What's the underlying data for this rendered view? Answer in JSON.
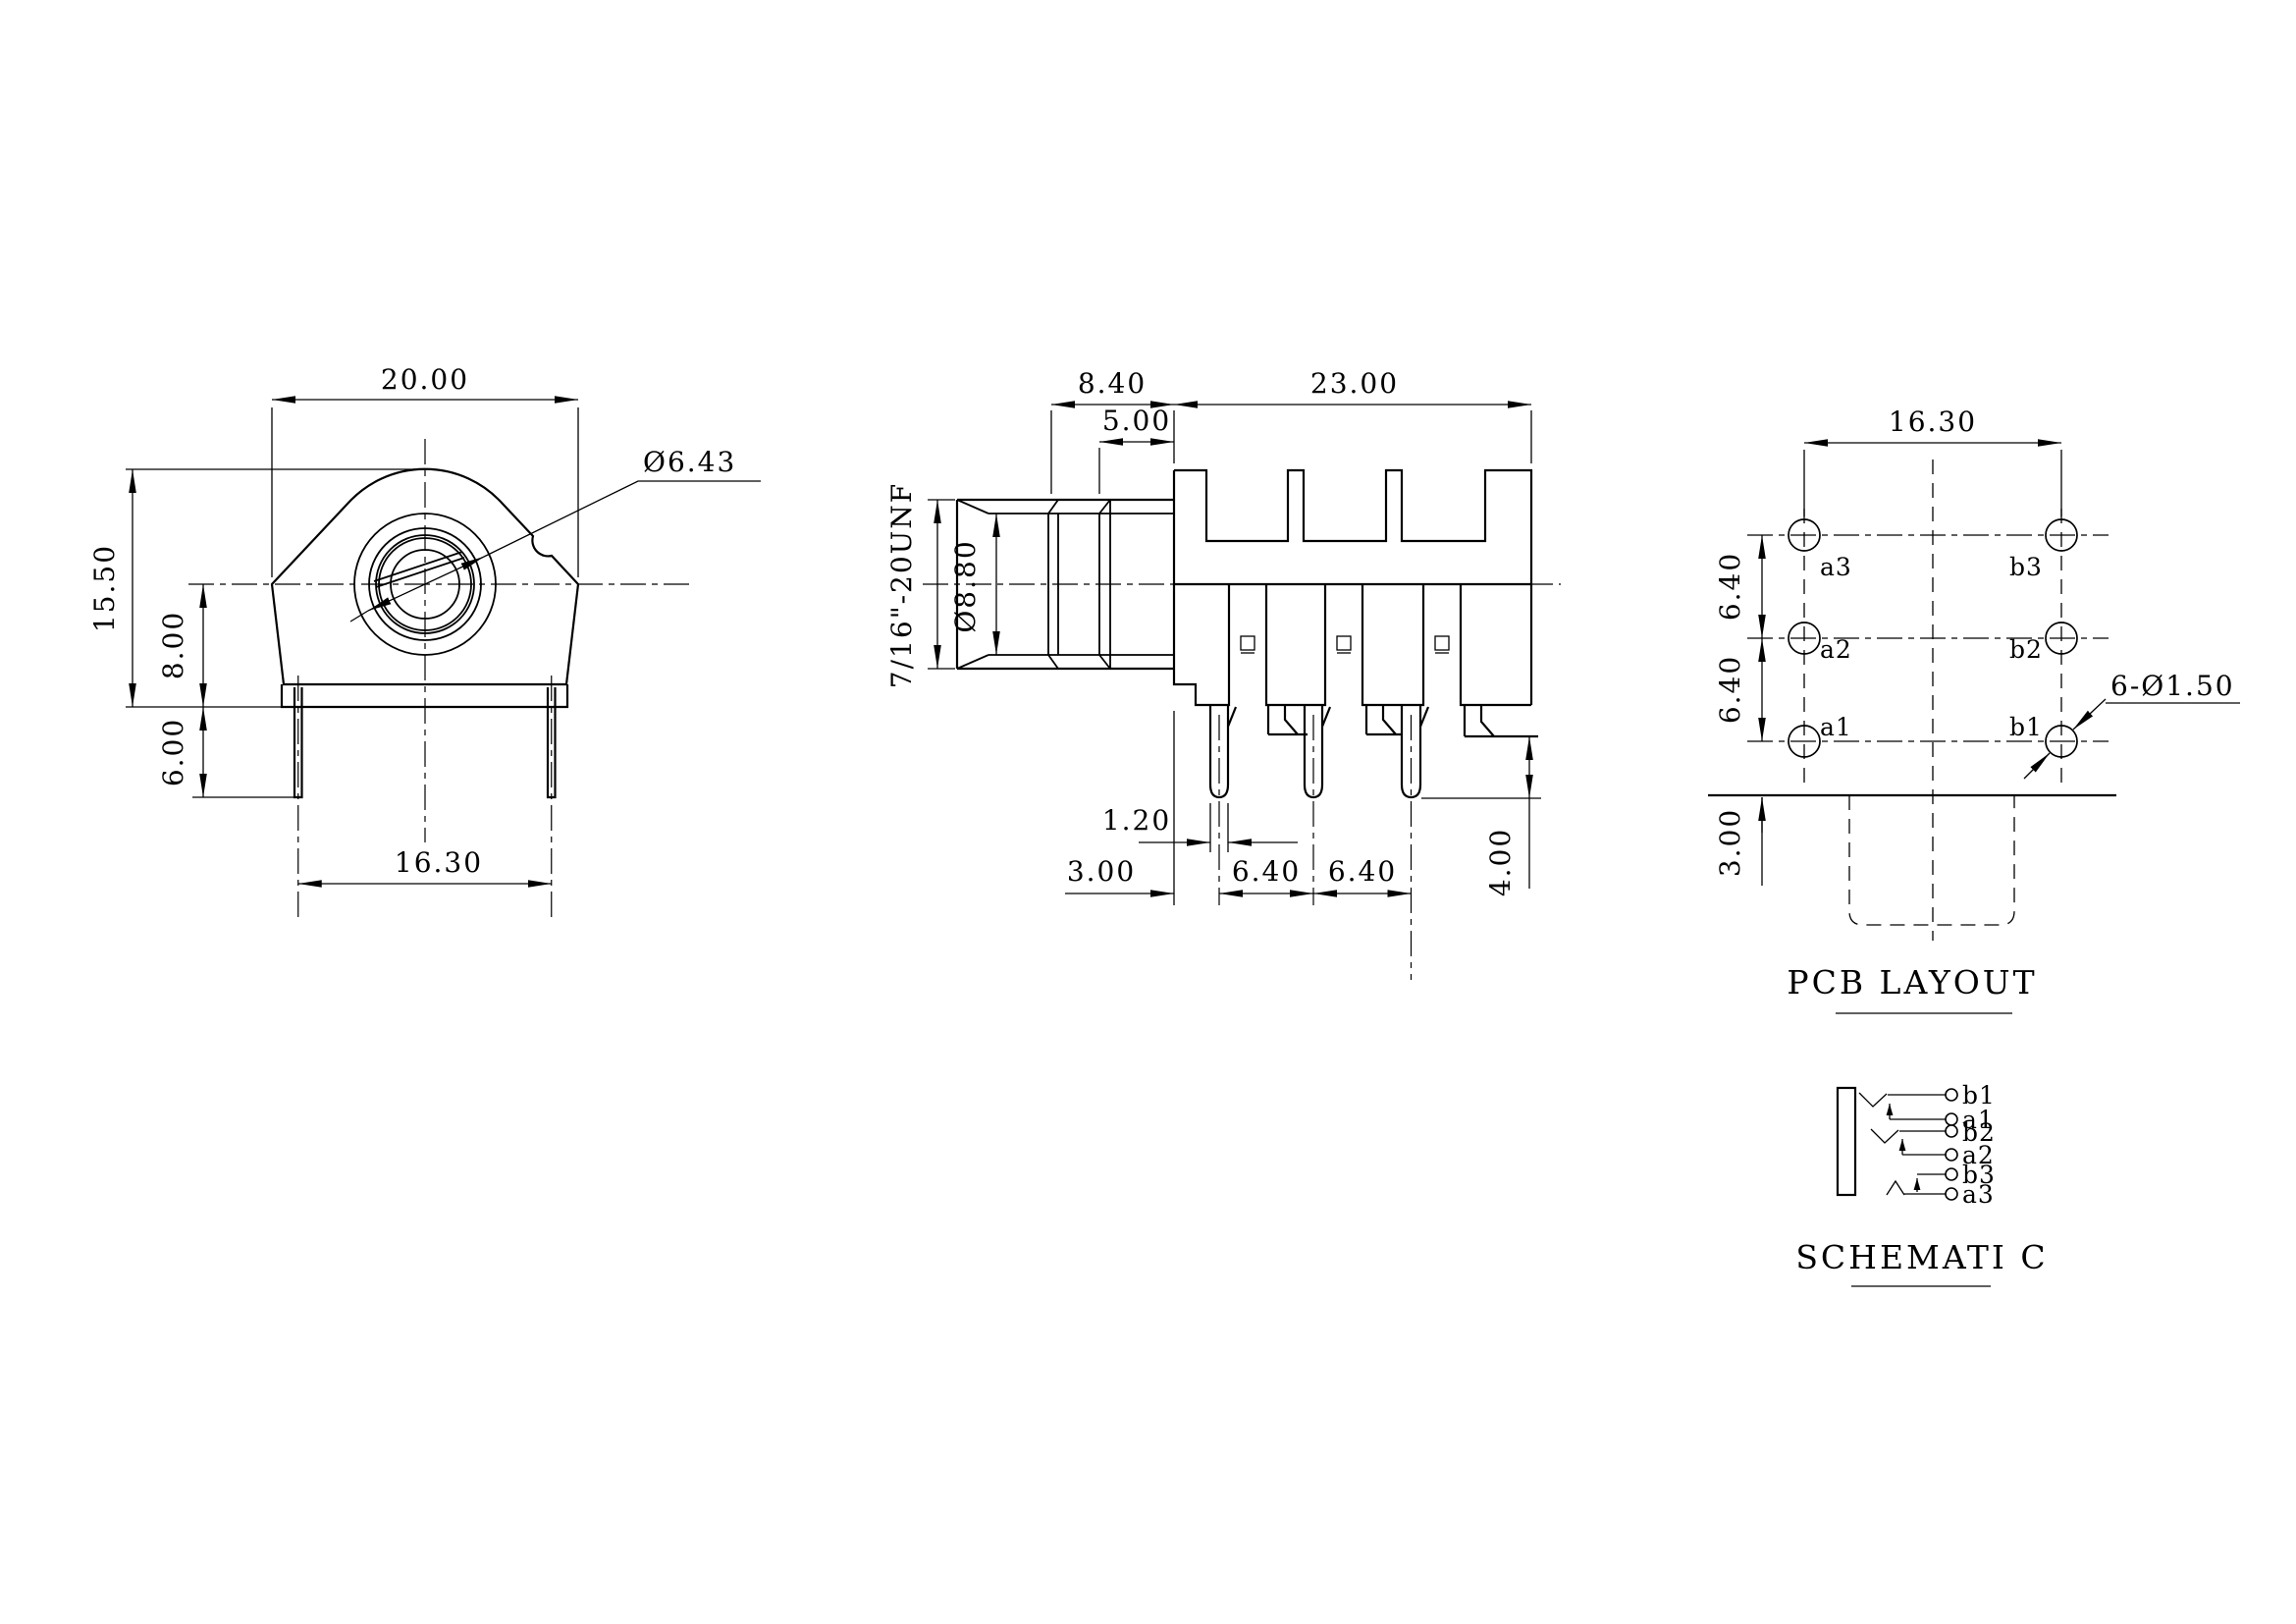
{
  "front_view": {
    "dim_width": "20.00",
    "dim_height": "15.50",
    "dim_center_height": "8.00",
    "dim_pin_length": "6.00",
    "dim_pin_span": "16.30",
    "dim_bore": "Ø6.43"
  },
  "side_view": {
    "dim_thread_length": "8.40",
    "dim_body_length": "23.00",
    "dim_neck": "5.00",
    "thread_spec": "7/16\"-20UNF",
    "dim_bushing_bore": "Ø8.80",
    "dim_pin_width": "1.20",
    "dim_face_to_pin": "3.00",
    "dim_pin_pitch_1": "6.40",
    "dim_pin_pitch_2": "6.40",
    "dim_pin_below": "4.00"
  },
  "pcb_layout": {
    "title": "PCB LAYOUT",
    "dim_col_span": "16.30",
    "dim_row_pitch_1": "6.40",
    "dim_row_pitch_2": "6.40",
    "dim_edge": "3.00",
    "holes_note": "6-Ø1.50",
    "pads": [
      "a3",
      "b3",
      "a2",
      "b2",
      "a1",
      "b1"
    ]
  },
  "schematic": {
    "title": "SCHEMATI C",
    "terminals": [
      "b1",
      "a1",
      "b2",
      "a2",
      "b3",
      "a3"
    ]
  },
  "colors": {
    "line": "#000000",
    "background": "#ffffff"
  }
}
